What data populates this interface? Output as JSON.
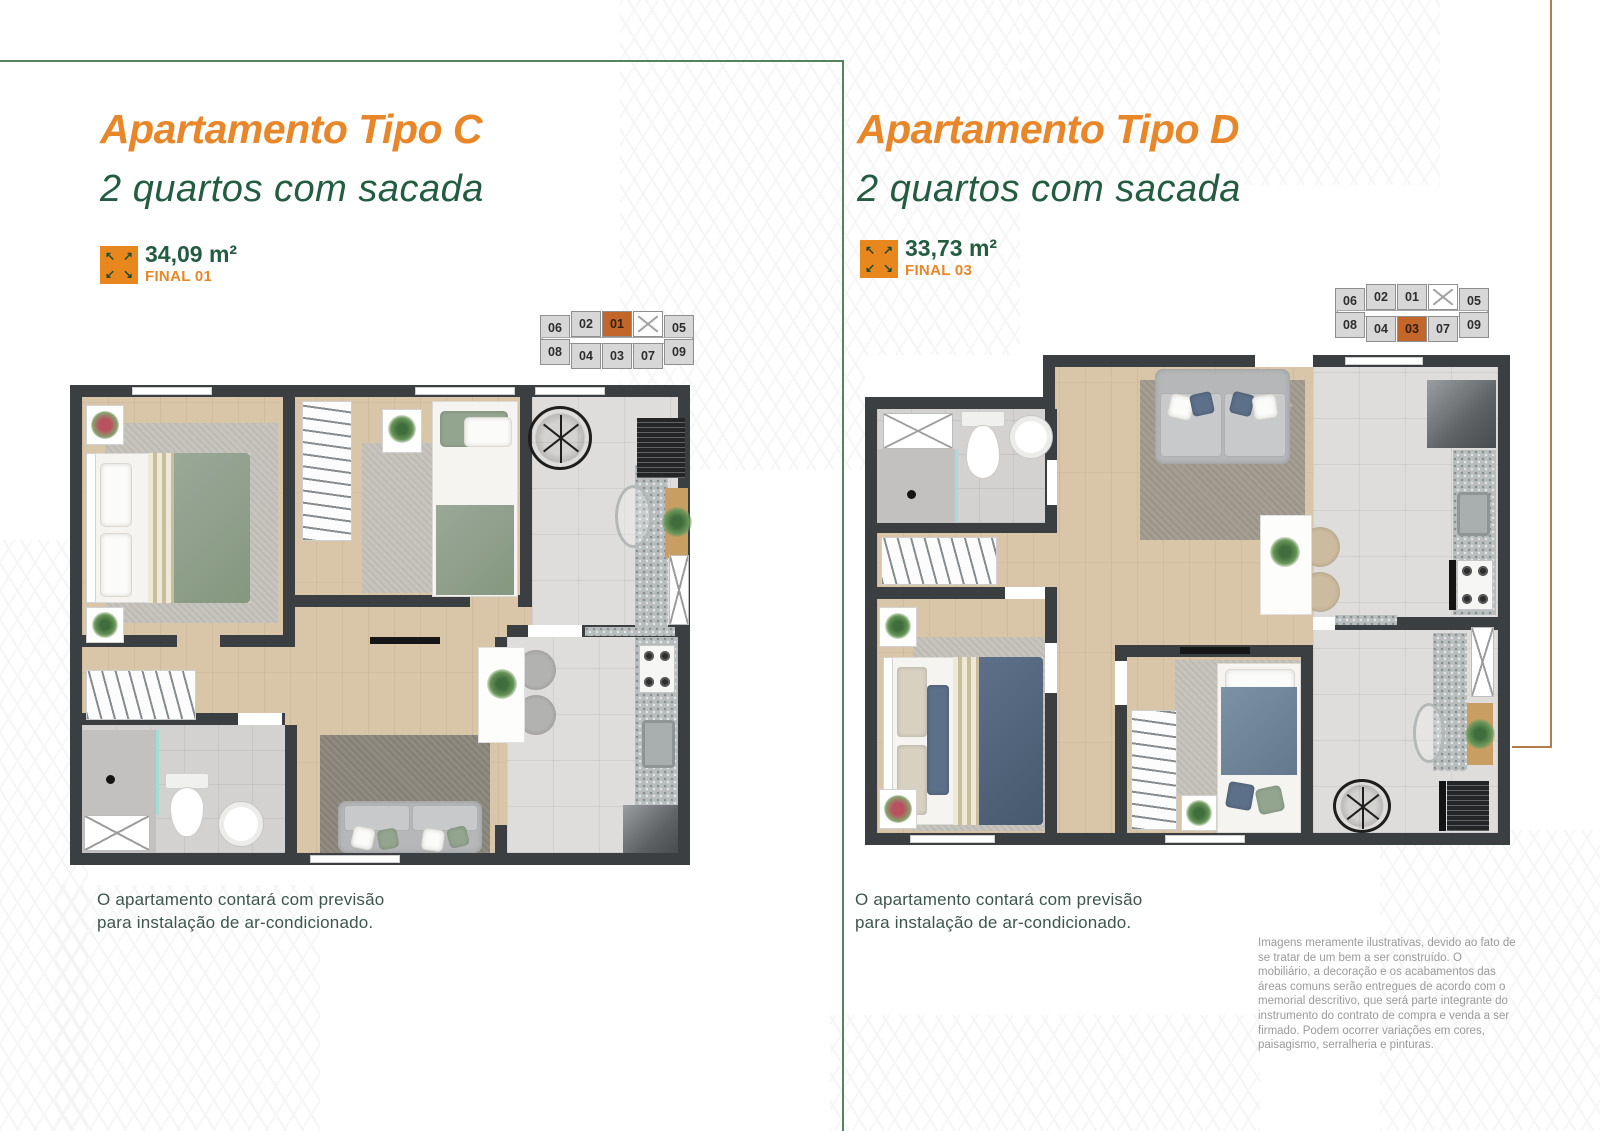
{
  "colors": {
    "accent_orange": "#E8872A",
    "accent_green": "#235C40",
    "frame_green": "#56825F",
    "frame_orange": "#B67B4B",
    "keyplan_highlight": "#C2662A",
    "wall": "#3C3F42"
  },
  "icons": {
    "area_icon": "expand-arrows-icon",
    "elevator_icon": "elevator-x-icon"
  },
  "panels": [
    {
      "title": "Apartamento Tipo C",
      "subtitle": "2 quartos com sacada",
      "area": "34,09 m²",
      "final": "FINAL 01",
      "note_lines": [
        "O apartamento contará com previsão",
        "para instalação de ar-condicionado."
      ],
      "keyplan": {
        "top": [
          "06",
          "02",
          "01",
          "05"
        ],
        "bottom": [
          "08",
          "04",
          "03",
          "07",
          "09"
        ],
        "highlighted": "01"
      }
    },
    {
      "title": "Apartamento Tipo D",
      "subtitle": "2 quartos com sacada",
      "area": "33,73 m²",
      "final": "FINAL 03",
      "note_lines": [
        "O apartamento contará com previsão",
        "para instalação de ar-condicionado."
      ],
      "keyplan": {
        "top": [
          "06",
          "02",
          "01",
          "05"
        ],
        "bottom": [
          "08",
          "04",
          "03",
          "07",
          "09"
        ],
        "highlighted": "03"
      }
    }
  ],
  "disclaimer": "Imagens meramente ilustrativas, devido ao fato de se tratar de um bem a ser construído. O mobiliário, a decoração e os acabamentos das áreas comuns serão entregues de acordo com o memorial descritivo, que será parte integrante do instrumento do contrato de compra e venda a ser firmado. Podem ocorrer variações em cores, paisagismo, serralheria e pinturas."
}
